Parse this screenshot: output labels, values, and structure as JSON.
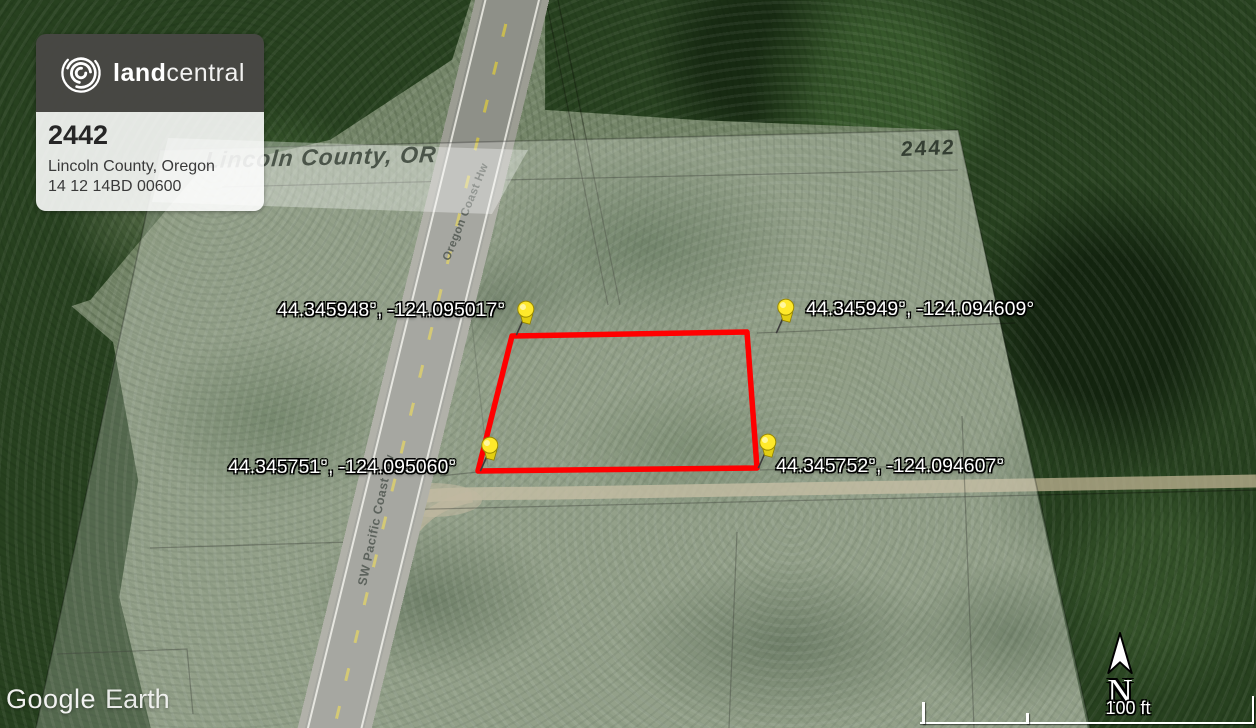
{
  "card": {
    "brand": {
      "land": "land",
      "central": "central"
    },
    "parcel_id": "2442",
    "location": "Lincoln County, Oregon",
    "apn": "14 12 14BD 00600"
  },
  "map": {
    "county_label": "Lincoln County, OR",
    "parcel_overlay_label": "2442",
    "roads": [
      {
        "name": "Oregon Coast Hw"
      },
      {
        "name": "SW Pacific Coast Hw"
      }
    ],
    "pins": [
      {
        "id": "northwest",
        "coordinates": "44.345948°, -124.095017°"
      },
      {
        "id": "northeast",
        "coordinates": "44.345949°, -124.094609°"
      },
      {
        "id": "southwest",
        "coordinates": "44.345751°, -124.095060°"
      },
      {
        "id": "southeast",
        "coordinates": "44.345752°, -124.094607°"
      }
    ],
    "parcel_outline_color": "#ff0000",
    "pin_color": "#ffe92b"
  },
  "watermark": {
    "google": "Google",
    "earth": "Earth"
  },
  "compass": {
    "label": "N"
  },
  "scale_bar": {
    "label": "100 ft"
  }
}
